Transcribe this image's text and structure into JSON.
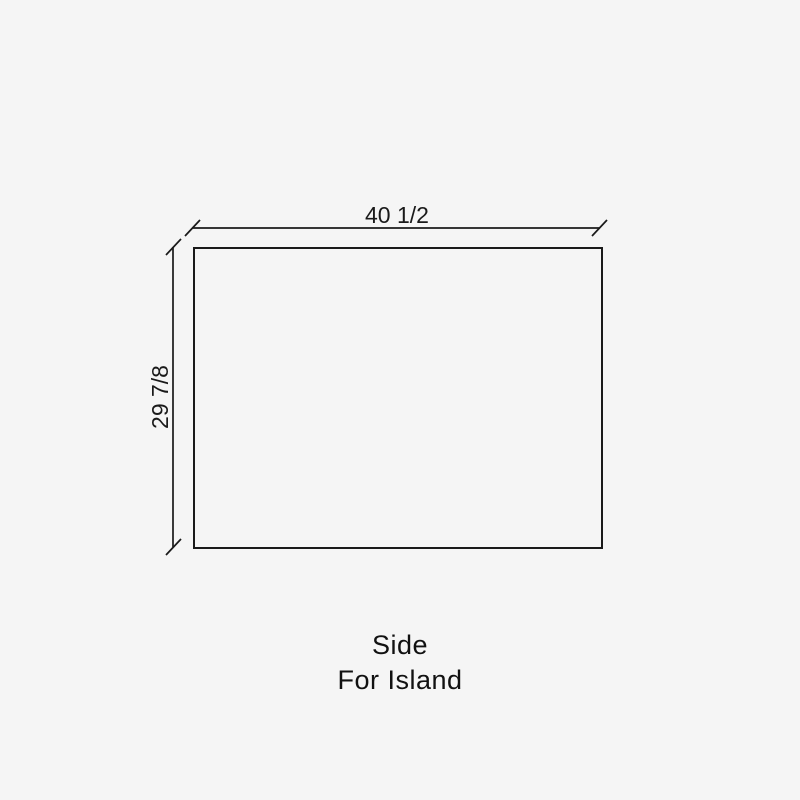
{
  "diagram": {
    "title": "Side panel dimension drawing",
    "dimensions": {
      "width_label": "40 1/2",
      "height_label": "29 7/8"
    },
    "caption": {
      "line1": "Side",
      "line2": "For Island"
    },
    "colors": {
      "background": "#f5f5f5",
      "line": "#1a1a1a",
      "text": "#111111"
    }
  }
}
